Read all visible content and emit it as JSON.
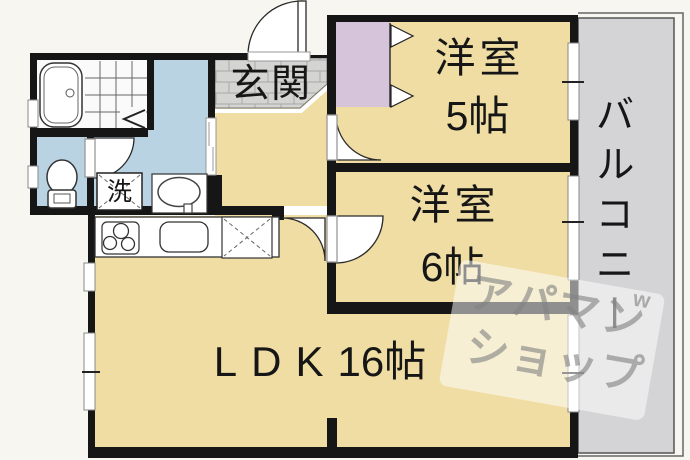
{
  "plan": {
    "entrance": {
      "label": "玄関"
    },
    "rooms": {
      "room5": {
        "name": "洋室",
        "size": "5帖"
      },
      "room6": {
        "name": "洋室",
        "size": "6帖"
      },
      "ldk": {
        "name": "LDK",
        "size": "16帖"
      },
      "balcony": {
        "label": "バルコニー"
      }
    },
    "fixtures": {
      "laundry": "洗"
    },
    "colors": {
      "room_floor": "#efdda3",
      "wet_floor": "#b9d3e2",
      "closet": "#d6c4da",
      "entrance_tile": "#d4d4d2",
      "balcony_floor": "#d4d4d6",
      "bath_floor": "#fafafa",
      "wall": "#161616"
    }
  },
  "watermark": {
    "line1": "アパマン",
    "line2": "ショップ",
    "mark": "w"
  }
}
